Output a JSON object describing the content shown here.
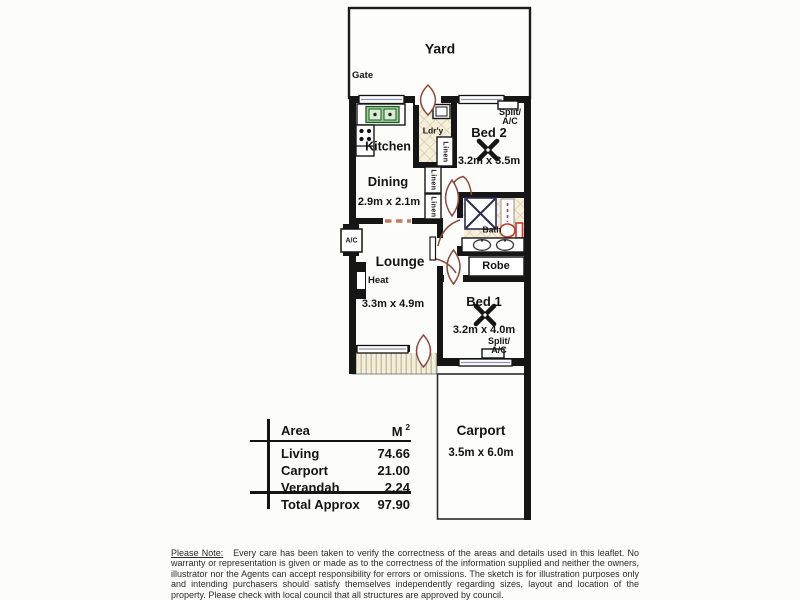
{
  "floorplan": {
    "outdoor": {
      "yard": "Yard",
      "gate": "Gate"
    },
    "kitchen": {
      "name": "Kitchen"
    },
    "dining": {
      "name": "Dining",
      "dims": "2.9m x 2.1m"
    },
    "laundry": {
      "name": "Ldr'y"
    },
    "linen_a": {
      "name": "Linen"
    },
    "linen_b": {
      "name": "Linen"
    },
    "linen_c": {
      "name": "Linen"
    },
    "bed2": {
      "name": "Bed 2",
      "dims": "3.2m x 3.5m",
      "ac_line1": "Split/",
      "ac_line2": "A/C"
    },
    "bath": {
      "name": "Bath"
    },
    "robe": {
      "name": "Robe"
    },
    "lounge": {
      "name": "Lounge",
      "dims": "3.3m x 4.9m",
      "heat": "Heat",
      "ac": "A/C"
    },
    "bed1": {
      "name": "Bed 1",
      "dims": "3.2m x 4.0m",
      "ac_line1": "Split/",
      "ac_line2": "A/C"
    },
    "carport": {
      "name": "Carport",
      "dims": "3.5m x 6.0m"
    }
  },
  "area_table": {
    "col_area": "Area",
    "col_unit": "M",
    "col_unit_sup": "2",
    "rows": [
      {
        "name": "Living",
        "value": "74.66"
      },
      {
        "name": "Carport",
        "value": "21.00"
      },
      {
        "name": "Verandah",
        "value": "2.24"
      }
    ],
    "total_name": "Total Approx",
    "total_value": "97.90"
  },
  "disclaimer": {
    "prefix": "Please Note:",
    "body": "Every care has been taken to verify the correctness of the areas and details used in this leaflet. No warranty or representation is given or made as to the correctness of the information supplied and neither the owners, illustrator nor the Agents can accept responsibility for errors or omissions. The sketch is for illustration purposes only and intending purchasers should satisfy themselves independently regarding sizes, layout and location of the property. Please check with local council that all structures are approved by council."
  }
}
